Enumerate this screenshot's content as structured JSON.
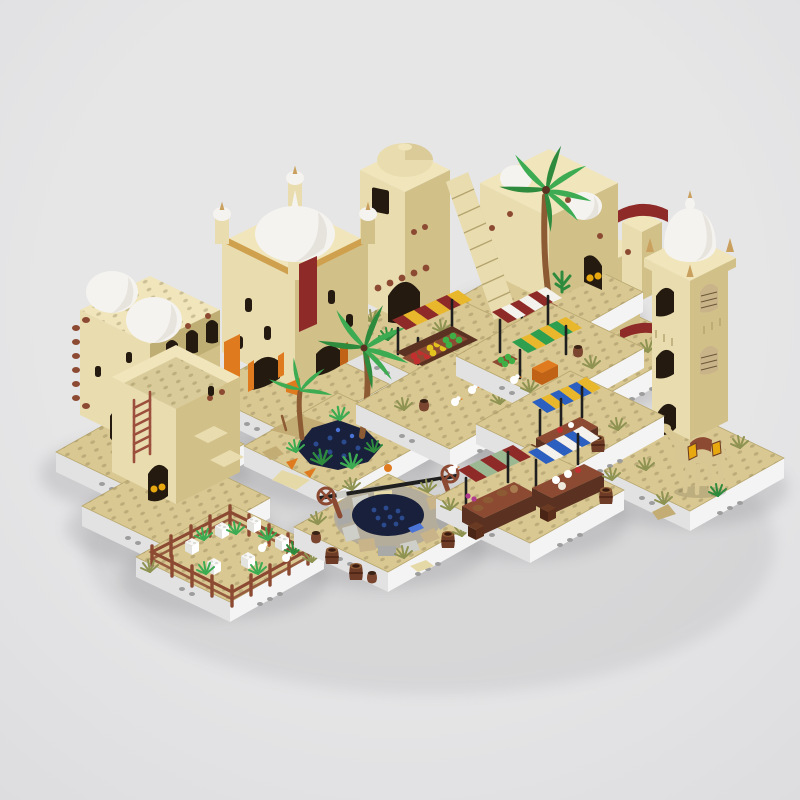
{
  "meta": {
    "description": "3D rendered product image of a LEGO-style modular desert town set: thirteen square baseplate modules with tan adobe buildings, white domes, market stalls with striped awnings, palm trees, an oasis, a stone well, a fenced garden and a camel, on a plain light-gray studio background with soft shadows.",
    "width": 800,
    "height": 800
  },
  "scene": {
    "title": "Desert town modular building set — isometric 3D render",
    "background": "plain light-gray studio backdrop, soft drop shadows under each white baseplate",
    "modules": [
      {
        "id": "red-roof-house",
        "label": "Tiered tan house with dark-red curved roofs, white mini dome and stairs",
        "position": "back row, right of center"
      },
      {
        "id": "palm-house",
        "label": "Adobe house with rooftop palm tree, two white domes, cactus and dark-red stand",
        "position": "back row, center-right"
      },
      {
        "id": "stair-tower",
        "label": "Gate tower with tan dome and grand side staircase over an arched gate",
        "position": "back row, center"
      },
      {
        "id": "castle-palace",
        "label": "Palace with large white dome, four corner turrets, gold trim, dark-red banner and orange arches",
        "position": "back row, center-left"
      },
      {
        "id": "flat-dome-house",
        "label": "Flat-roof building with twin white domes, timber beam ends and arched gallery",
        "position": "back row, far left"
      },
      {
        "id": "dome-tower",
        "label": "Tall minaret tower with white onion dome, lattice arch windows and a camel with saddle bags at its base",
        "position": "far right"
      },
      {
        "id": "ladder-house",
        "label": "House with rooftop terrace, reddish-brown ladder, black arched door and side stairs",
        "position": "middle row, left"
      },
      {
        "id": "oasis",
        "label": "Oasis plate with blue pond, two palm trees, green plants and orange fish",
        "position": "middle row, center-left"
      },
      {
        "id": "fruit-stall",
        "label": "Fruit market stall with dark-red and yellow striped awning, crates of red, yellow and green fruit, barrel and doves",
        "position": "middle row, center"
      },
      {
        "id": "striped-stalls",
        "label": "Market stalls with dark-red/white and green/yellow striped awnings, orange stand and crate of green fruit",
        "position": "middle row, center-right"
      },
      {
        "id": "blue-stall",
        "label": "Market stall with blue and yellow striped awning and brown counter",
        "position": "middle row, right"
      },
      {
        "id": "garden-pen",
        "label": "Fenced garden pen with white sacks, green sprouts and chickens",
        "position": "front row, left"
      },
      {
        "id": "stone-well",
        "label": "Round stone well with dark water, black axle with crank wheels, barrels and clay pots",
        "position": "front row, center"
      },
      {
        "id": "front-stalls",
        "label": "Two market stalls with green/dark-red and blue/white striped awnings selling bowls and pottery",
        "position": "front row, right"
      }
    ]
  },
  "palette": {
    "bg": "#e6e6e7",
    "bg_edge": "#dddde0",
    "plate_top": "#d9c892",
    "plate_side": "#f4f4f4",
    "plate_side_shade": "#e2e2e2",
    "wall_light": "#e9ddb0",
    "wall_mid": "#d2c089",
    "wall_dark": "#bfae74",
    "wall_top": "#f0e5bb",
    "dome_white": "#f5f3ef",
    "dome_shade": "#d9d5cd",
    "gold": "#cfa14e",
    "gold_bright": "#e8a80f",
    "dark_red": "#8e2b28",
    "orange": "#e07a1e",
    "orange_dark": "#c06316",
    "red_brown": "#8c4a33",
    "dark_brown": "#5b3222",
    "ladder_brown": "#9c4f3d",
    "trunk_brown": "#8c5a33",
    "opening_dark": "#241a10",
    "leaf_green": "#3cab52",
    "leaf_dark": "#2e8b3d",
    "olive": "#8f9352",
    "water": "#18203c",
    "water_stud": "#2c4a8e",
    "water_light": "#4a74d8",
    "sand_dark": "#c3ad74",
    "sand_light": "#e6d9a8",
    "awning_yellow": "#e8b72b",
    "awning_green": "#2e9e4f",
    "awning_blue": "#2b5fc0",
    "awning_white": "#f4f2ec",
    "sage_green": "#9cb893",
    "fruit_red": "#c22f2f",
    "fruit_yellow": "#e3c41f",
    "fruit_green": "#3fae44",
    "stone_gray": "#a9a9a7",
    "stone_light": "#cfcfc9",
    "stone_tan": "#c9b48a",
    "camel_tan": "#d8c793",
    "black": "#1f1f1f"
  }
}
